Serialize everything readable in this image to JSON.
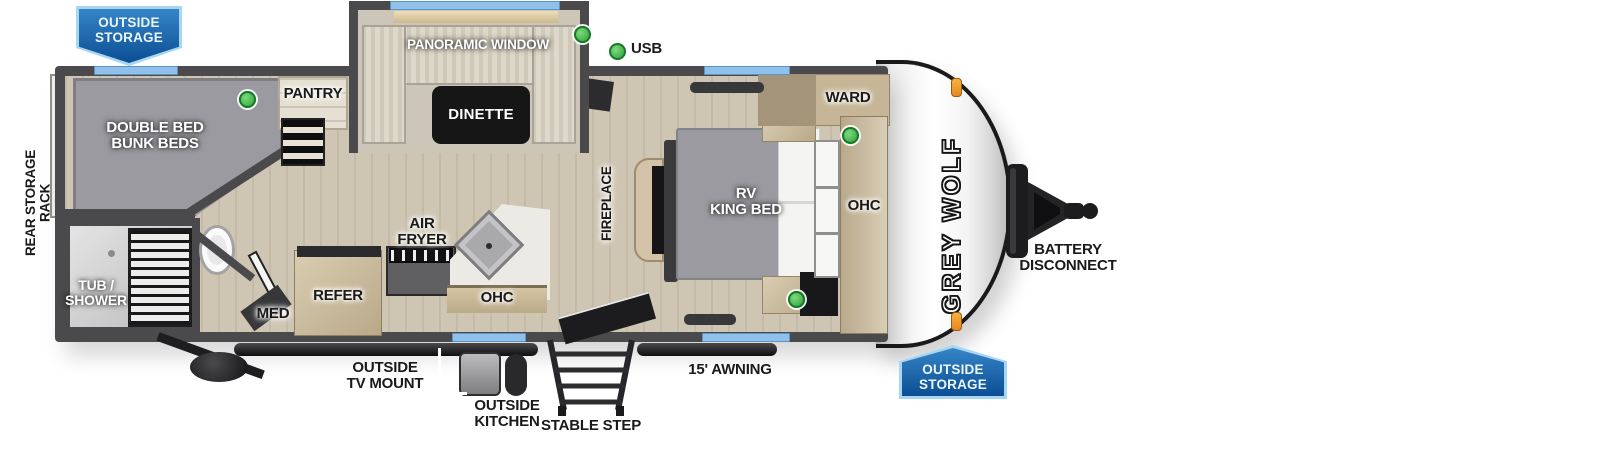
{
  "title": "Grey Wolf travel trailer floor plan",
  "brand": {
    "logo_text": "GREY WOLF"
  },
  "legend": {
    "usb": "USB"
  },
  "flags": {
    "front_outside_storage": "OUTSIDE\nSTORAGE",
    "rear_outside_storage": "OUTSIDE\nSTORAGE"
  },
  "labels": {
    "rear_storage_rack": "REAR STORAGE RACK",
    "panoramic_window": "PANORAMIC WINDOW",
    "pantry": "PANTRY",
    "bunks": "DOUBLE BED\nBUNK BEDS",
    "dinette": "DINETTE",
    "fireplace": "FIREPLACE",
    "king_bed": "RV\nKING BED",
    "ward": "WARD",
    "ohc_bedroom": "OHC",
    "ohc_kitchen": "OHC",
    "tub_shower": "TUB /\nSHOWER",
    "med": "MED",
    "refer": "REFER",
    "air_fryer": "AIR\nFRYER",
    "outside_tv_mount": "OUTSIDE\nTV MOUNT",
    "outside_kitchen": "OUTSIDE\nKITCHEN",
    "stable_step": "STABLE STEP",
    "awning": "15' AWNING",
    "battery_disconnect": "BATTERY\nDISCONNECT"
  },
  "colors": {
    "wall_gray": "#4a4a4c",
    "window_blue": "#8fc1ea",
    "flag_blue": "#0c4e93",
    "indicator_green": "#3db54a",
    "clearance_marker_orange": "#f0a13a",
    "floor_tan": "#cfc5b3"
  }
}
